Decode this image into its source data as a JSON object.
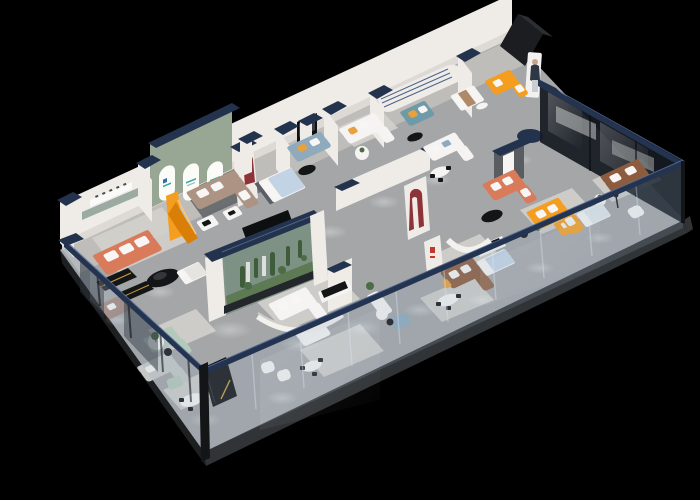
{
  "scene": {
    "type": "3d-isometric-floorplan-render",
    "subject": "Cutaway aerial 3D floor plan of a furniture showroom on a black backdrop",
    "orientation": "long axis runs lower-left to upper-right; glass curtain walls on the two front sides and right side; white partition rooms along the back side",
    "rooms": [
      "coral-sofa-suite",
      "arched-gallery-with-brand-logos",
      "orange-display-stand",
      "taupe-sectional-suite",
      "blue-bedding-bedroom",
      "media-wall-lounge",
      "teal-sofa-nook",
      "curved-groove-feature-wall",
      "white-sofa-suites",
      "terrarium-display-case",
      "sage-green-lounge",
      "dining-table-sets",
      "leather-sectional-suite",
      "bright-orange-sofa-suites",
      "glass-partition-rooms",
      "brown-sofa-room",
      "bedroom-displays",
      "black-display-monoliths"
    ],
    "signage": {
      "arch_logos": "small blue and teal brand marks inside three arched windows",
      "wall_plaque": "tiny dark lettering plaque on left room back wall",
      "red_brand_mark": "small red logo marks on white partition",
      "cutout_figure": "standing-woman display cutout near top-right entrance"
    }
  },
  "palette": {
    "bg": "#000000",
    "floor": "#a4a6a8",
    "roomFloor": "#c7c4bf",
    "rug": "#d2d0cc",
    "rugDark": "#63666a",
    "slabFront": "#313437",
    "slabSide": "#1d1f21",
    "wall": "#efece8",
    "wallShade": "#ddd9d4",
    "wallSide": "#c6c2bc",
    "cap": "#24334d",
    "capHi": "#4c6388",
    "sageWall": "#98a694",
    "arch": "#fbfbf8",
    "orange": "#f59d1e",
    "orangeDeep": "#d97f07",
    "salmon": "#d97b5a",
    "taupe": "#ad9383",
    "brown": "#8d5c3e",
    "sageSofa": "#b3c9ba",
    "teal": "#6f9aa8",
    "blueGray": "#8fa9bd",
    "bedBlue": "#c2d3e6",
    "white": "#f5f4f2",
    "graySofa": "#c6c8c6",
    "black": "#141517",
    "gold": "#c79a3d",
    "red": "#8e3338",
    "redBright": "#c0392b",
    "glassTint": "#91aabe",
    "glassDark": "#161b22",
    "glassRail": "#243450",
    "glassHi": "#58719b",
    "plant": "#4d6b44",
    "cactus": "#3e5c3a",
    "moss": "#5d7a55",
    "terrGlass": "#7b8f82",
    "screen": "#0e0f11"
  }
}
